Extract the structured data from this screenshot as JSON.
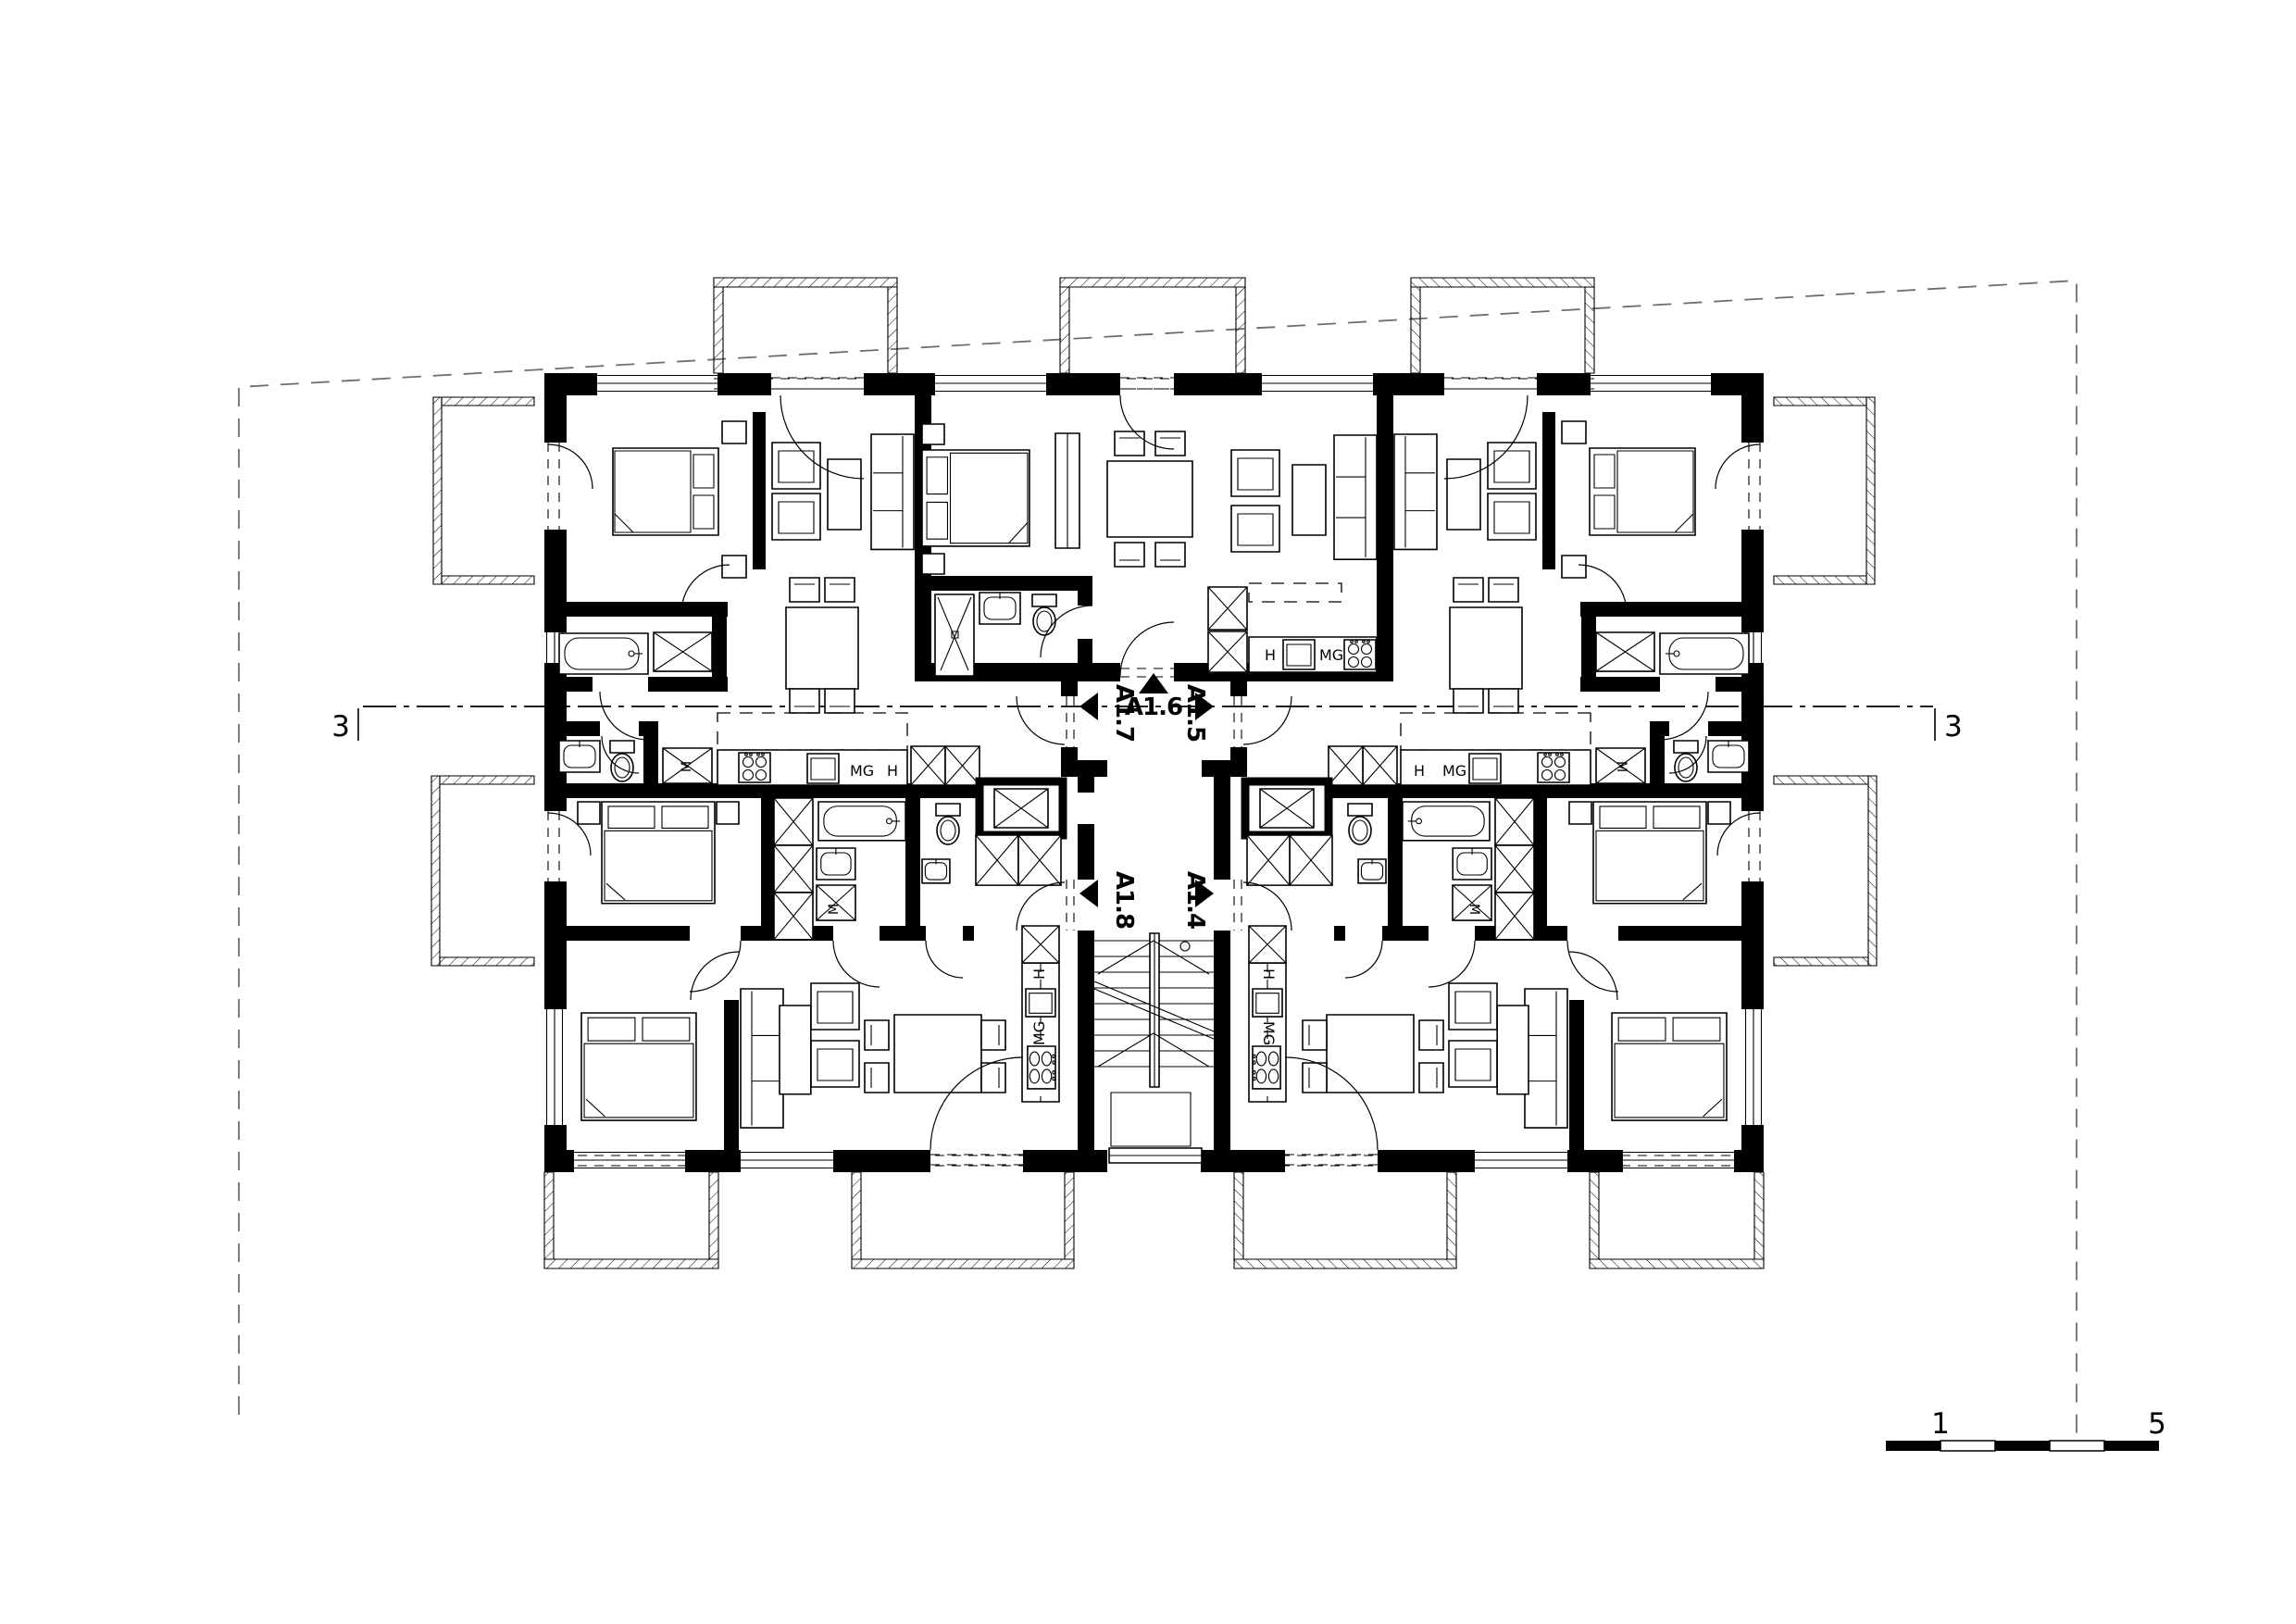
{
  "drawing": {
    "type": "architectural floor plan",
    "storey": "apartment building typical floor",
    "background_color": "#ffffff",
    "line_color": "#000000"
  },
  "section_marks": {
    "left": "3",
    "right": "3"
  },
  "scale_bar": {
    "label_1": "1",
    "label_5": "5"
  },
  "apartments": [
    {
      "id": "A1.4",
      "entry_arrow": "right"
    },
    {
      "id": "A1.5",
      "entry_arrow": "right"
    },
    {
      "id": "A1.6",
      "entry_arrow": "up"
    },
    {
      "id": "A1.7",
      "entry_arrow": "left"
    },
    {
      "id": "A1.8",
      "entry_arrow": "left"
    }
  ],
  "appliances": {
    "hob": "H",
    "microwave": "MG",
    "washing_machine": "M"
  }
}
